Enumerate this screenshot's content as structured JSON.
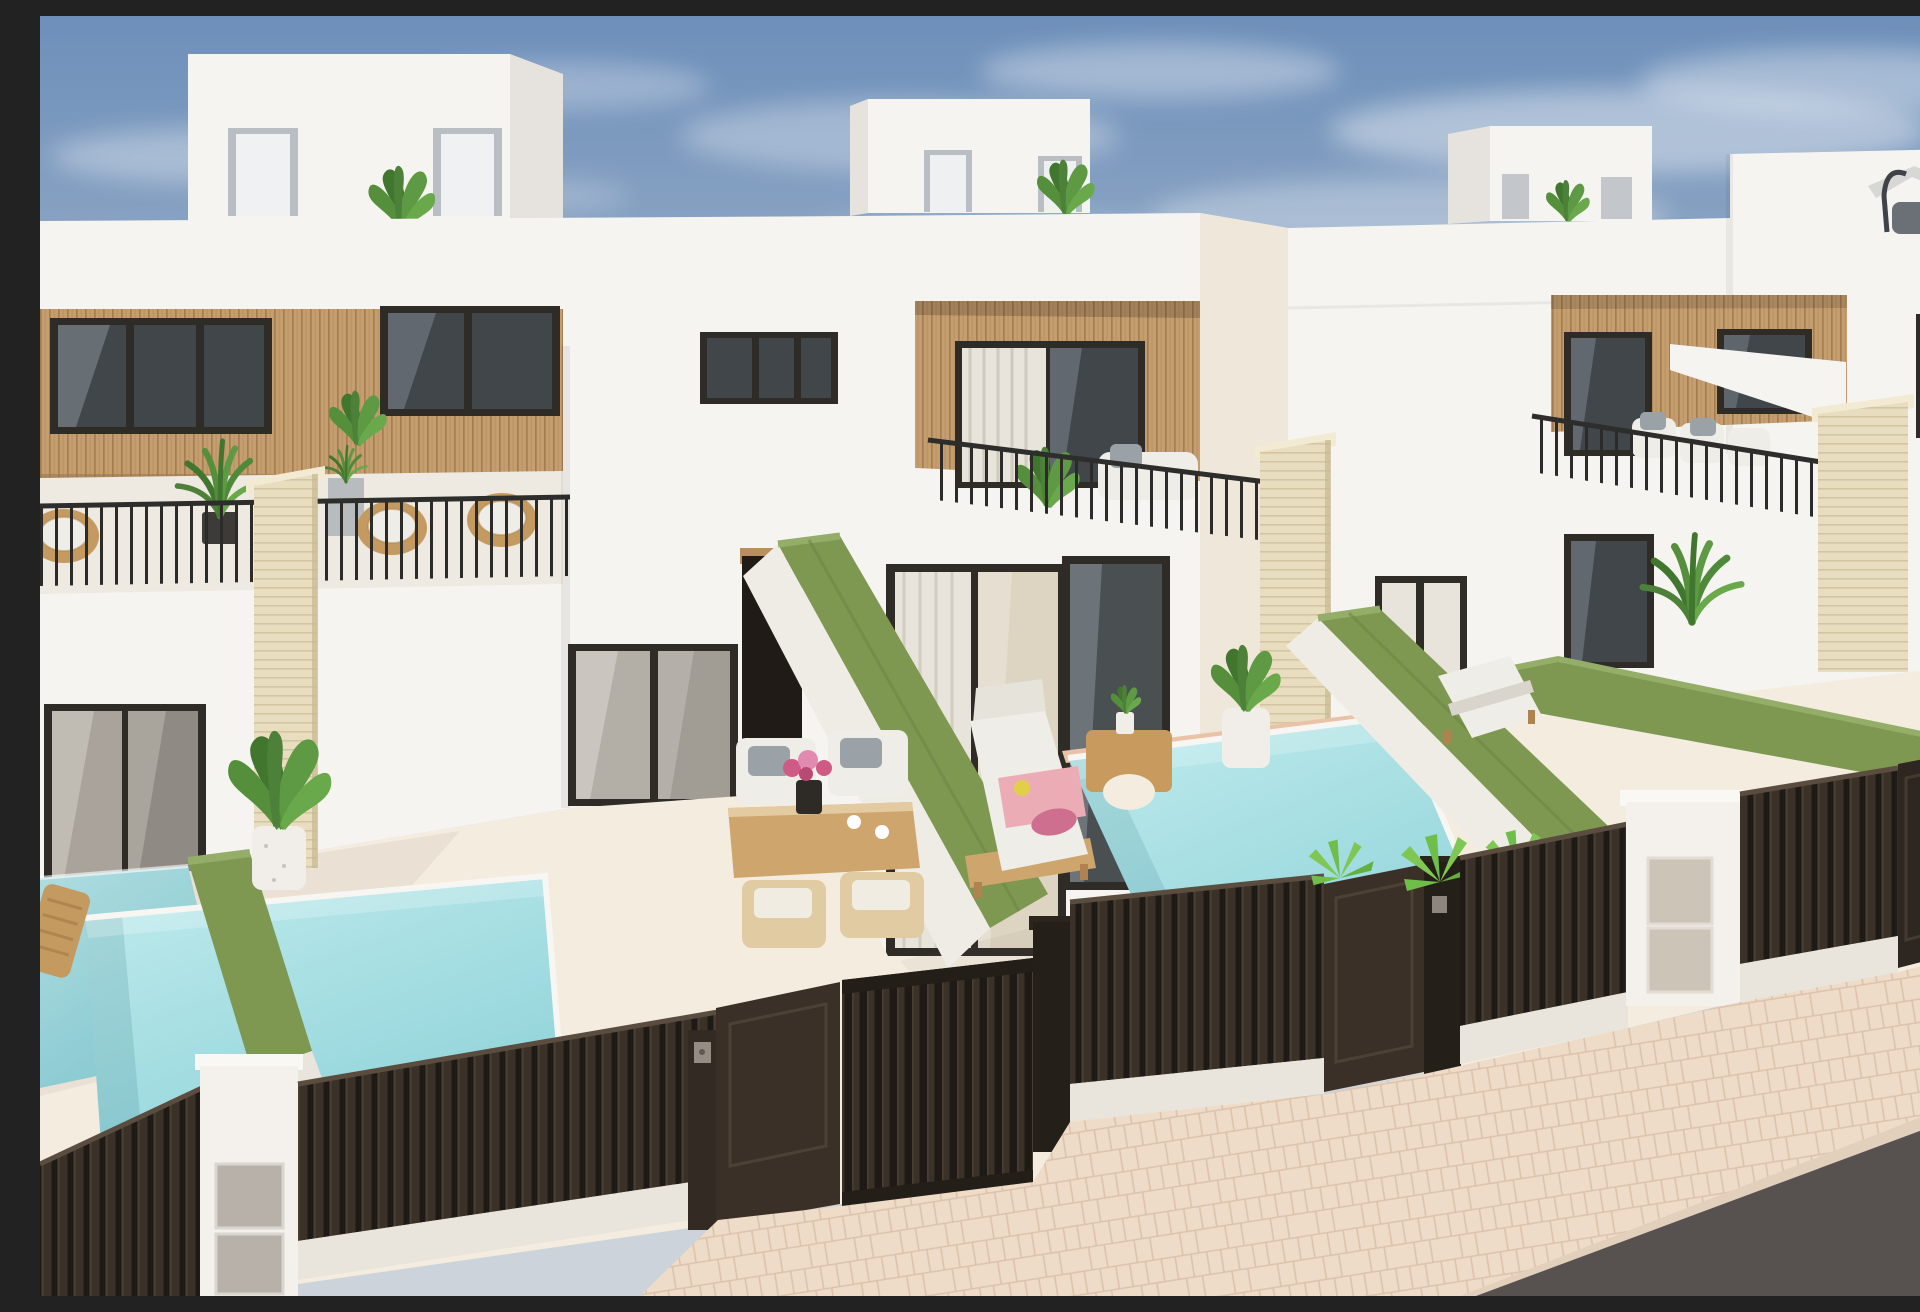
{
  "scene": {
    "title": "New-build modern townhouses with private pools",
    "description": "Sunny 3D architectural render, elevated three-quarter view of a row of white flat-roofed townhouses with wood-slat clad upper floors, black-framed glazing, rooftop terraces, green hedge privacy walls, small turquoise private pools, dark brown vertical-slat street fences and gates, beige herringbone sidewalk and asphalt road.",
    "view": "high-angle exterior perspective",
    "lighting": "bright daylight, sun from the right",
    "sky": "blue with wispy cirrus clouds"
  },
  "palette": {
    "sky_top": "#6d8fba",
    "sky_mid": "#94abc6",
    "sky_horizon": "#cdd3da",
    "cloud_white": "#ffffff",
    "wall_lit": "#f6f4f0",
    "wall_shade": "#e6e3de",
    "wall_warm_side": "#efe7d9",
    "wall_cool_shade": "#dddad4",
    "wood_clad": "#c59e70",
    "wood_line": "#a57d52",
    "wood_lintel": "#b98f60",
    "frame_dark": "#2f2b27",
    "glass_dark": "#41464b",
    "glass_reflect": "#aeb9c2",
    "glass_interior": "#ded4c2",
    "curtain": "#e8e4db",
    "railing_dark": "#2c2b29",
    "travertine": "#e8ddbf",
    "travertine_line": "#d4c5a2",
    "hedge_green": "#7e9852",
    "hedge_light": "#94ad68",
    "hedge_dark": "#688243",
    "pool_light": "#c0ebed",
    "pool_deep": "#8fd3d9",
    "coping_white": "#f8f6f2",
    "floor_patio": "#f3ecdf",
    "fence_slat": "#3a3129",
    "fence_gap": "#1f1a15",
    "fence_highlight": "#5a4c3e",
    "fence_base": "#e9e4dc",
    "gate_solid": "#3a3027",
    "post_dark": "#251f19",
    "pillar_street": "#f4f1ec",
    "meter_panel": "#b7b1a9",
    "meter_panel_beige": "#cdc4b8",
    "sidewalk": "#efdcc8",
    "paving_line": "#dcc2ab",
    "road": "#575150",
    "kerb": "#e3d0bc",
    "furniture_wood": "#cfa56e",
    "furniture_pale": "#e0cba3",
    "cushion_white": "#efede7",
    "pillow_gray": "#9ba2a7",
    "rattan": "#c49a61",
    "towel_pink": "#ecacb6",
    "towel_magenta": "#cf6f90",
    "flower_pink": "#cf5a86",
    "accent_yellow": "#e2cf49",
    "plant_green": "#5d9a43",
    "plant_dark": "#41762f",
    "plant_bright": "#7fc653",
    "parasol_gray": "#d7d7d5",
    "parasol_frame": "#3f4246"
  },
  "buildings": [
    {
      "id": "unit-1",
      "position": "left",
      "features": [
        "rooftop penthouse with two white doors",
        "wood-slat clad upper band with two dark windows",
        "roof terrace with black bar railing, rattan chairs, palms and gray planter",
        "travertine boundary pillar",
        "ground-floor sliding glass doors",
        "patio dining set",
        "private pool"
      ]
    },
    {
      "id": "unit-2",
      "position": "center",
      "features": [
        "rooftop penthouse with banana plant",
        "recessed wood-clad balcony with sofa and plant",
        "black bar balcony railing",
        "large corner glazing on ground floor",
        "sun lounger with pink towels",
        "arched wooden side table",
        "potted plant",
        "private pool"
      ]
    },
    {
      "id": "unit-3",
      "position": "right",
      "features": [
        "rooftop penthouse with plant",
        "wood-clad balcony with white sofa",
        "black bar railing",
        "ground-floor windows",
        "sun lounger in yard"
      ]
    },
    {
      "id": "unit-4",
      "position": "far-right",
      "features": [
        "tall white block",
        "rooftop parasol with curved arm",
        "travertine boundary wall"
      ]
    }
  ],
  "pools": [
    {
      "id": "pool-neighbor-left",
      "color_ref": "pool_light"
    },
    {
      "id": "pool-unit-1",
      "color_ref": "pool_light"
    },
    {
      "id": "pool-unit-2",
      "color_ref": "pool_light"
    }
  ],
  "hedges": [
    {
      "id": "hedge-left-boundary"
    },
    {
      "id": "hedge-unit1-unit2"
    },
    {
      "id": "hedge-unit2-unit3"
    },
    {
      "id": "hedge-unit3-unit4"
    }
  ],
  "street": {
    "fence": "dark brown vertical slat panels on low white base wall",
    "gates": [
      "solid pedestrian door unit 1",
      "vertical-slat sliding gate unit 1",
      "open gate leaf unit 2",
      "gate unit 3 far right"
    ],
    "entry_pillars": [
      "white pillar with two metal meter doors (left)",
      "white pillar with two beige meter doors (right)"
    ],
    "keypads": 2,
    "sidewalk": "beige herringbone pavers",
    "road": "dark asphalt, bottom right corner"
  },
  "furniture": [
    "wooden slat lounger (left neighbor terrace)",
    "outdoor dining table with pink flower vase and two cups",
    "two white-cushion chairs with gray pillows",
    "two pale wood chairs",
    "sun lounger with white cushion, pink towel and yellow accessory",
    "arched wooden side table with small plant",
    "white lounger in right yard",
    "white balcony sofas with gray pillows",
    "rattan lounge chairs on roof terrace"
  ],
  "vegetation": [
    "banana plants on penthouse terraces",
    "tall palm in dark pot on roof terrace",
    "large potted strelitzia on patio",
    "potted plant beside pool 2",
    "bright fan palms along fence",
    "palm behind hedge in right yard"
  ]
}
